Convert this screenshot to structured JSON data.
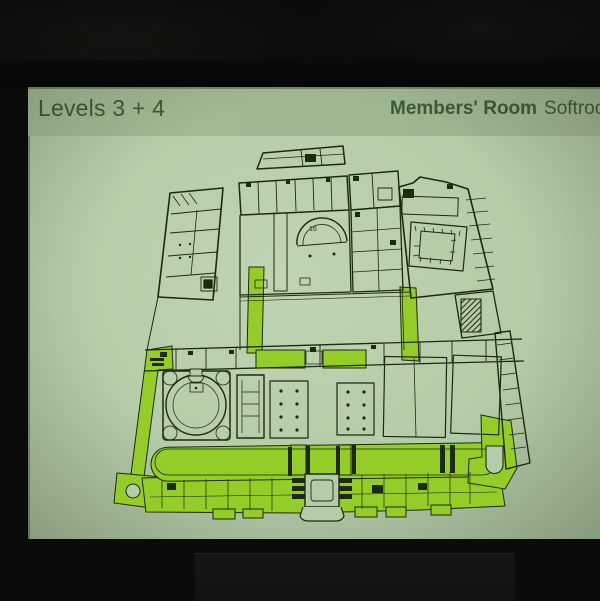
{
  "meta": {
    "scene": "Photograph of a presentation slide projected on a screen in a dark room"
  },
  "colors": {
    "room_background": "#0b0c0a",
    "slide_background": "#b5cca9",
    "header_band": "#a3ba95",
    "header_text": "#3b5a36",
    "plan_ink": "#1d2912",
    "highlight_green": "#94cd27",
    "lectern_panel": "#151513",
    "cable_gray": "#7d7d72"
  },
  "slide": {
    "header": {
      "title": "Levels 3 + 4",
      "credit_bold": "Members' Room",
      "credit_regular": "Softroom"
    },
    "plan": {
      "subject": "Museum floor plan, levels 3 and 4, circulation and gallery areas highlighted in green",
      "room_number_label": "16",
      "highlighted_areas": [
        "west-diagonal-corridor",
        "south-long-gallery",
        "south-range-rooms",
        "central-courtyard-corridor",
        "mid-range-link-rooms",
        "east-court-corridor",
        "south-east-stair-link"
      ]
    }
  }
}
